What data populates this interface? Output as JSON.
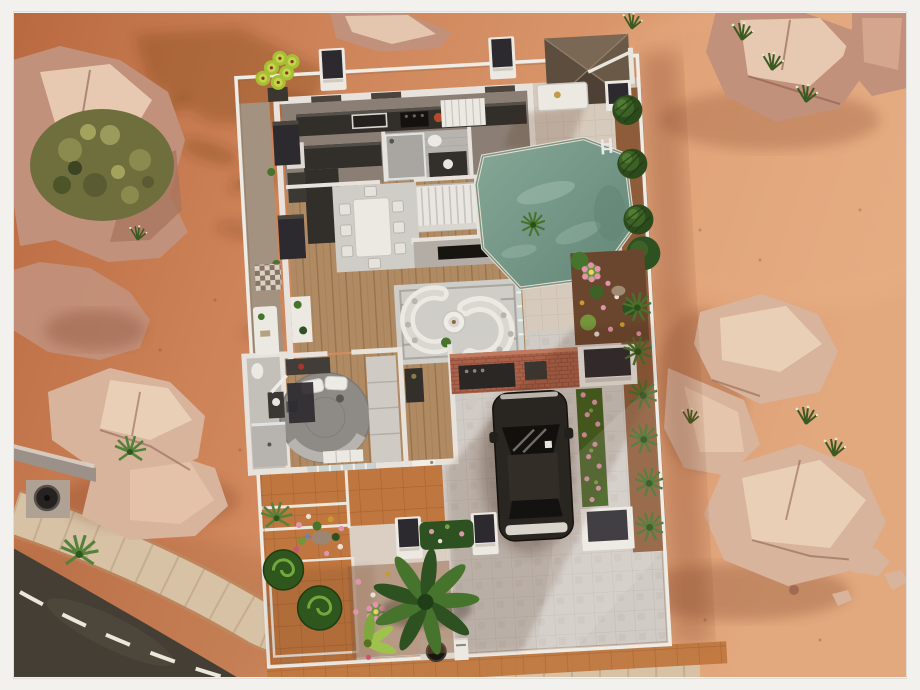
{
  "meta": {
    "type": "game-screenshot",
    "view": "top-down lot / floor-plan render",
    "subject": "modern desert house on a fenced lot, framed like a gallery photo",
    "visible_text": "none"
  },
  "colors": {
    "frame": "#f2f1ee",
    "sandDeep": "#b96940",
    "sandMid": "#cd8257",
    "sandLight": "#e2a87e",
    "road": "#453e35",
    "roadLine": "#ece7db",
    "sidewalk": "#d7c2a6",
    "sidewalkSeam": "#b49878",
    "rockBase": "#c2917c",
    "rockPale": "#d8b49d",
    "rockLight": "#ecd2ba",
    "rockDark": "#8a5c4b",
    "bushOlive": "#6f6f3e",
    "leaf": "#47742c",
    "leafDark": "#2d5120",
    "leafBright": "#a9bf33",
    "fence": "#efece6",
    "wall": "#e7e3dc",
    "furnWhite": "#ece9e3",
    "counter": "#322e2a",
    "rug": "#cfcdc8",
    "wood": "#b08a62",
    "driveway": "#d1cbc5",
    "patioTile": "#d6cabc",
    "terracotta": "#c0773f",
    "poolWater": "#86a796",
    "poolDeep": "#628677",
    "canopy": "#6b5947",
    "brick": "#aa6149",
    "carBody": "#292521",
    "carGlass": "#11100d",
    "flowerPink": "#e194ab",
    "soil": "#6b462e",
    "mulch": "#8f5c3a",
    "planterDark": "#2d2a2f",
    "bedGray": "#8e8a85",
    "glass": "#ccd4d2",
    "deck": "#a3927f",
    "tileBath": "#b7b3ae"
  },
  "scene": {
    "environment": [
      "desert sand with palm-tree shadows",
      "rock formations with olive scrub and agaves",
      "asphalt road with white dashed line at bottom-left",
      "curved tiled sidewalk",
      "street trash bin on concrete pad",
      "grass tufts with seed heads"
    ],
    "lot_outdoor": [
      "white perimeter fence",
      "swimming pool with steel ladder",
      "pyramid shade canopy with white arm",
      "white patio table",
      "three conifer hedges on mulch",
      "flower bed with blooming cacti",
      "row of yucca plants along east fence",
      "two white planter boxes with dark tops",
      "pink flower hedge strip",
      "paved driveway with long building shadow",
      "front cactus garden with spiral topiaries and large fern",
      "white walkway and terracotta paths",
      "lot trash can and white mailbox",
      "dark planter pillars",
      "lime succulent at north-west corner"
    ],
    "house_rooms": [
      {
        "name": "kitchen",
        "features": [
          "dark stone counter",
          "sink",
          "stove",
          "fruit bowl",
          "white curtain",
          "L-shaped dark island",
          "fridge"
        ]
      },
      {
        "name": "shower-bathroom",
        "features": [
          "glass shower",
          "toilet",
          "dark vanity"
        ]
      },
      {
        "name": "staircase",
        "features": [
          "white stairs"
        ]
      },
      {
        "name": "dining-room",
        "features": [
          "long white table",
          "eight white chairs",
          "grey rug",
          "hardwood floor"
        ]
      },
      {
        "name": "living-room",
        "features": [
          "two curved white sofas",
          "round coffee table",
          "grey bordered rug",
          "TV media wall",
          "white console with plants"
        ]
      },
      {
        "name": "outdoor-bar",
        "features": [
          "brick counter",
          "built-in grill",
          "stools"
        ]
      },
      {
        "name": "bedroom",
        "features": [
          "large round grey bed",
          "white pillows",
          "wardrobe",
          "dark dresser",
          "bench",
          "sliding glass door"
        ]
      },
      {
        "name": "second-bathroom",
        "features": [
          "shower",
          "toilet",
          "vanity",
          "open door"
        ]
      },
      {
        "name": "entry-hall",
        "features": [
          "dark console",
          "front door"
        ]
      }
    ],
    "vehicle": {
      "type": "SUV",
      "color": "dark espresso",
      "location": "driveway",
      "facing": "north"
    }
  }
}
